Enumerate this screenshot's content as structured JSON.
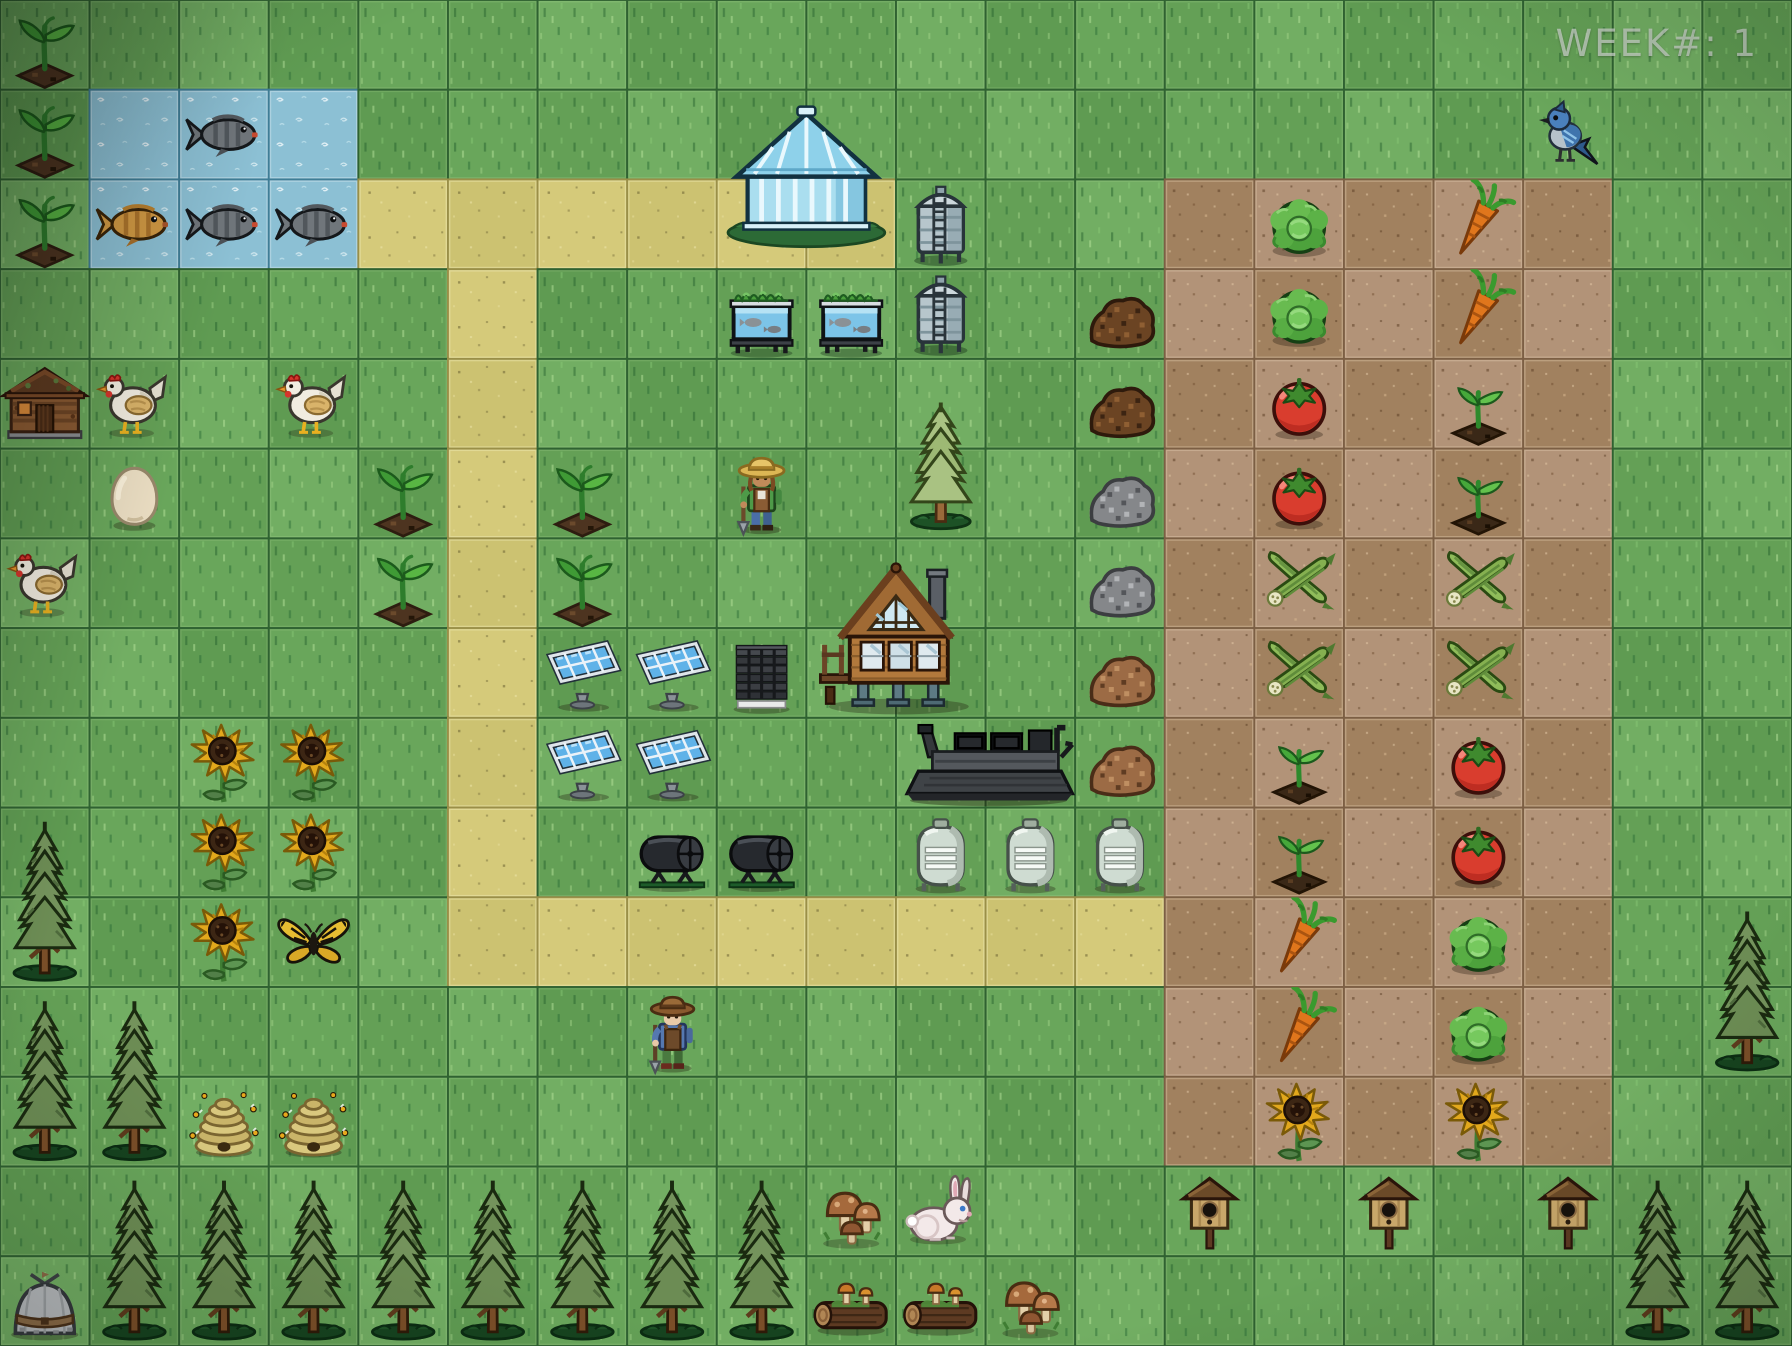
{
  "hud": {
    "week_label": "WEEK#: 1"
  },
  "board": {
    "cols": 20,
    "rows": 15,
    "tile": {
      "w": 89.6,
      "h": 89.7333
    },
    "palette": {
      "grass": [
        "#69a65b",
        "#5f9b52",
        "#72ae63",
        "#64a056"
      ],
      "grass_line": "#2f6231",
      "grass_bevel": "rgba(205,235,175,0.16)",
      "water": "#8cc0d4",
      "water_line": "#3f7d96",
      "water_bevel": "rgba(255,255,255,0.28)",
      "path": [
        "#d5ca7a",
        "#ccc271"
      ],
      "path_line": "#9a8f48",
      "path_bevel": "rgba(250,245,200,0.35)",
      "soil": [
        "#b29378",
        "#a1815f"
      ],
      "soil_line": "#7c5f44",
      "soil_bevel": "rgba(235,215,185,0.35)"
    },
    "terrain": {
      "water_tiles": [
        [
          1,
          1
        ],
        [
          2,
          1
        ],
        [
          3,
          1
        ],
        [
          1,
          2
        ],
        [
          2,
          2
        ],
        [
          3,
          2
        ]
      ],
      "path_tiles": [
        [
          4,
          2
        ],
        [
          5,
          2
        ],
        [
          6,
          2
        ],
        [
          7,
          2
        ],
        [
          8,
          2
        ],
        [
          9,
          2
        ],
        [
          5,
          3
        ],
        [
          5,
          4
        ],
        [
          5,
          5
        ],
        [
          5,
          6
        ],
        [
          5,
          7
        ],
        [
          5,
          8
        ],
        [
          5,
          9
        ],
        [
          5,
          10
        ],
        [
          6,
          10
        ],
        [
          7,
          10
        ],
        [
          8,
          10
        ],
        [
          9,
          10
        ],
        [
          10,
          10
        ],
        [
          11,
          10
        ],
        [
          12,
          10
        ]
      ],
      "soil_rect": {
        "col0": 13,
        "row0": 2,
        "col1": 17,
        "row1": 12
      }
    },
    "sprites": [
      {
        "t": "sprout",
        "n": "seedling",
        "c": 0,
        "r": 0
      },
      {
        "t": "sprout",
        "n": "seedling",
        "c": 0,
        "r": 1
      },
      {
        "t": "sprout",
        "n": "seedling",
        "c": 0,
        "r": 2
      },
      {
        "t": "fish_gray",
        "n": "pond-fish",
        "c": 2,
        "r": 1
      },
      {
        "t": "fish_gold",
        "n": "goldfish",
        "c": 1,
        "r": 2
      },
      {
        "t": "fish_gray",
        "n": "pond-fish",
        "c": 2,
        "r": 2
      },
      {
        "t": "fish_gray",
        "n": "pond-fish",
        "c": 3,
        "r": 2
      },
      {
        "t": "bird",
        "n": "blue-jay",
        "c": 17,
        "r": 1
      },
      {
        "t": "greenhouse",
        "n": "greenhouse",
        "c": 8,
        "r": 1,
        "w": 2,
        "h": 2
      },
      {
        "t": "silo",
        "n": "water-silo",
        "c": 10,
        "r": 2
      },
      {
        "t": "silo",
        "n": "water-silo",
        "c": 10,
        "r": 3
      },
      {
        "t": "aquatank",
        "n": "aquaponics-tank",
        "c": 8,
        "r": 3
      },
      {
        "t": "aquatank",
        "n": "aquaponics-tank",
        "c": 9,
        "r": 3
      },
      {
        "t": "lettuce",
        "n": "lettuce-crop",
        "c": 14,
        "r": 2
      },
      {
        "t": "lettuce",
        "n": "lettuce-crop",
        "c": 14,
        "r": 3
      },
      {
        "t": "carrot",
        "n": "carrot-crop",
        "c": 16,
        "r": 2
      },
      {
        "t": "carrot",
        "n": "carrot-crop",
        "c": 16,
        "r": 3
      },
      {
        "t": "compost",
        "n": "compost-pile",
        "c": 12,
        "r": 3
      },
      {
        "t": "compost",
        "n": "compost-pile",
        "c": 12,
        "r": 4
      },
      {
        "t": "cabin",
        "n": "log-cabin",
        "c": 0,
        "r": 4
      },
      {
        "t": "chicken",
        "n": "chicken",
        "c": 1,
        "r": 4
      },
      {
        "t": "chicken",
        "n": "chicken",
        "c": 3,
        "r": 4
      },
      {
        "t": "tomato",
        "n": "tomato-crop",
        "c": 14,
        "r": 4
      },
      {
        "t": "tomato",
        "n": "tomato-crop",
        "c": 14,
        "r": 5
      },
      {
        "t": "soilsprout",
        "n": "soil-seedling",
        "c": 16,
        "r": 4
      },
      {
        "t": "soilsprout",
        "n": "soil-seedling",
        "c": 16,
        "r": 5
      },
      {
        "t": "egg",
        "n": "egg",
        "c": 1,
        "r": 5
      },
      {
        "t": "sprout",
        "n": "seedling",
        "c": 4,
        "r": 5
      },
      {
        "t": "sprout",
        "n": "seedling",
        "c": 6,
        "r": 5
      },
      {
        "t": "farmer1",
        "n": "farmer-straw-hat",
        "c": 8,
        "r": 5
      },
      {
        "t": "pine_light",
        "n": "young-pine-tree",
        "c": 10,
        "r": 4,
        "h": 2
      },
      {
        "t": "gravel",
        "n": "gravel-pile",
        "c": 12,
        "r": 5
      },
      {
        "t": "gravel",
        "n": "gravel-pile",
        "c": 12,
        "r": 6
      },
      {
        "t": "chicken",
        "n": "chicken",
        "c": 0,
        "r": 6
      },
      {
        "t": "sprout",
        "n": "seedling",
        "c": 4,
        "r": 6
      },
      {
        "t": "sprout",
        "n": "seedling",
        "c": 6,
        "r": 6
      },
      {
        "t": "house",
        "n": "stilt-house",
        "c": 9,
        "r": 6,
        "w": 2,
        "h": 2
      },
      {
        "t": "okra",
        "n": "okra-crop",
        "c": 14,
        "r": 6
      },
      {
        "t": "okra",
        "n": "okra-crop",
        "c": 16,
        "r": 6
      },
      {
        "t": "okra",
        "n": "okra-crop",
        "c": 14,
        "r": 7
      },
      {
        "t": "okra",
        "n": "okra-crop",
        "c": 16,
        "r": 7
      },
      {
        "t": "solar",
        "n": "solar-panel",
        "c": 6,
        "r": 7
      },
      {
        "t": "solar",
        "n": "solar-panel",
        "c": 7,
        "r": 7
      },
      {
        "t": "pallet",
        "n": "pallet-stack",
        "c": 8,
        "r": 7
      },
      {
        "t": "mulch",
        "n": "mulch-pile",
        "c": 12,
        "r": 7
      },
      {
        "t": "mulch",
        "n": "mulch-pile",
        "c": 12,
        "r": 8
      },
      {
        "t": "sunflower",
        "n": "sunflower",
        "c": 2,
        "r": 8
      },
      {
        "t": "sunflower",
        "n": "sunflower",
        "c": 3,
        "r": 8
      },
      {
        "t": "solar",
        "n": "solar-panel",
        "c": 6,
        "r": 8
      },
      {
        "t": "solar",
        "n": "solar-panel",
        "c": 7,
        "r": 8
      },
      {
        "t": "harvester",
        "n": "combine-harvester",
        "c": 10,
        "r": 8,
        "w": 2
      },
      {
        "t": "soilsprout",
        "n": "soil-seedling",
        "c": 14,
        "r": 8
      },
      {
        "t": "tomato",
        "n": "tomato-crop",
        "c": 16,
        "r": 8
      },
      {
        "t": "pine_dark",
        "n": "pine-tree",
        "c": 0,
        "r": 9,
        "h": 2
      },
      {
        "t": "sunflower",
        "n": "sunflower",
        "c": 2,
        "r": 9
      },
      {
        "t": "sunflower",
        "n": "sunflower",
        "c": 3,
        "r": 9
      },
      {
        "t": "tumbler",
        "n": "compost-tumbler",
        "c": 7,
        "r": 9
      },
      {
        "t": "tumbler",
        "n": "compost-tumbler",
        "c": 8,
        "r": 9
      },
      {
        "t": "gastank",
        "n": "storage-tank",
        "c": 10,
        "r": 9
      },
      {
        "t": "gastank",
        "n": "storage-tank",
        "c": 11,
        "r": 9
      },
      {
        "t": "gastank",
        "n": "storage-tank",
        "c": 12,
        "r": 9
      },
      {
        "t": "soilsprout",
        "n": "soil-seedling",
        "c": 14,
        "r": 9
      },
      {
        "t": "tomato",
        "n": "tomato-crop",
        "c": 16,
        "r": 9
      },
      {
        "t": "sunflower",
        "n": "sunflower",
        "c": 2,
        "r": 10
      },
      {
        "t": "butterfly",
        "n": "butterfly",
        "c": 3,
        "r": 10
      },
      {
        "t": "carrot",
        "n": "carrot-crop",
        "c": 14,
        "r": 10
      },
      {
        "t": "lettuce",
        "n": "lettuce-crop",
        "c": 16,
        "r": 10
      },
      {
        "t": "pine_dark",
        "n": "pine-tree",
        "c": 19,
        "r": 10,
        "h": 2
      },
      {
        "t": "pine_dark",
        "n": "pine-tree",
        "c": 0,
        "r": 11,
        "h": 2
      },
      {
        "t": "pine_dark",
        "n": "pine-tree",
        "c": 1,
        "r": 11,
        "h": 2
      },
      {
        "t": "farmer2",
        "n": "farmer-brown-hat",
        "c": 7,
        "r": 11
      },
      {
        "t": "carrot",
        "n": "carrot-crop",
        "c": 14,
        "r": 11
      },
      {
        "t": "lettuce",
        "n": "lettuce-crop",
        "c": 16,
        "r": 11
      },
      {
        "t": "beehive",
        "n": "beehive",
        "c": 2,
        "r": 12
      },
      {
        "t": "beehive",
        "n": "beehive",
        "c": 3,
        "r": 12
      },
      {
        "t": "sunflower",
        "n": "sunflower",
        "c": 14,
        "r": 12
      },
      {
        "t": "sunflower",
        "n": "sunflower",
        "c": 16,
        "r": 12
      },
      {
        "t": "pine_dark",
        "n": "pine-tree",
        "c": 1,
        "r": 13,
        "h": 2
      },
      {
        "t": "pine_dark",
        "n": "pine-tree",
        "c": 2,
        "r": 13,
        "h": 2
      },
      {
        "t": "pine_dark",
        "n": "pine-tree",
        "c": 3,
        "r": 13,
        "h": 2
      },
      {
        "t": "pine_dark",
        "n": "pine-tree",
        "c": 4,
        "r": 13,
        "h": 2
      },
      {
        "t": "pine_dark",
        "n": "pine-tree",
        "c": 5,
        "r": 13,
        "h": 2
      },
      {
        "t": "pine_dark",
        "n": "pine-tree",
        "c": 6,
        "r": 13,
        "h": 2
      },
      {
        "t": "pine_dark",
        "n": "pine-tree",
        "c": 7,
        "r": 13,
        "h": 2
      },
      {
        "t": "pine_dark",
        "n": "pine-tree",
        "c": 8,
        "r": 13,
        "h": 2
      },
      {
        "t": "mushrooms",
        "n": "mushroom-cluster",
        "c": 9,
        "r": 13
      },
      {
        "t": "rabbit",
        "n": "rabbit",
        "c": 10,
        "r": 13
      },
      {
        "t": "birdhouse",
        "n": "birdhouse",
        "c": 13,
        "r": 13
      },
      {
        "t": "birdhouse",
        "n": "birdhouse",
        "c": 15,
        "r": 13
      },
      {
        "t": "birdhouse",
        "n": "birdhouse",
        "c": 17,
        "r": 13
      },
      {
        "t": "pine_dark",
        "n": "pine-tree",
        "c": 18,
        "r": 13,
        "h": 2
      },
      {
        "t": "pine_dark",
        "n": "pine-tree",
        "c": 19,
        "r": 13,
        "h": 2
      },
      {
        "t": "tipi",
        "n": "yurt",
        "c": 0,
        "r": 14
      },
      {
        "t": "log",
        "n": "mossy-log",
        "c": 9,
        "r": 14
      },
      {
        "t": "log",
        "n": "mossy-log",
        "c": 10,
        "r": 14
      },
      {
        "t": "mushrooms",
        "n": "mushroom-cluster",
        "c": 11,
        "r": 14
      }
    ]
  }
}
